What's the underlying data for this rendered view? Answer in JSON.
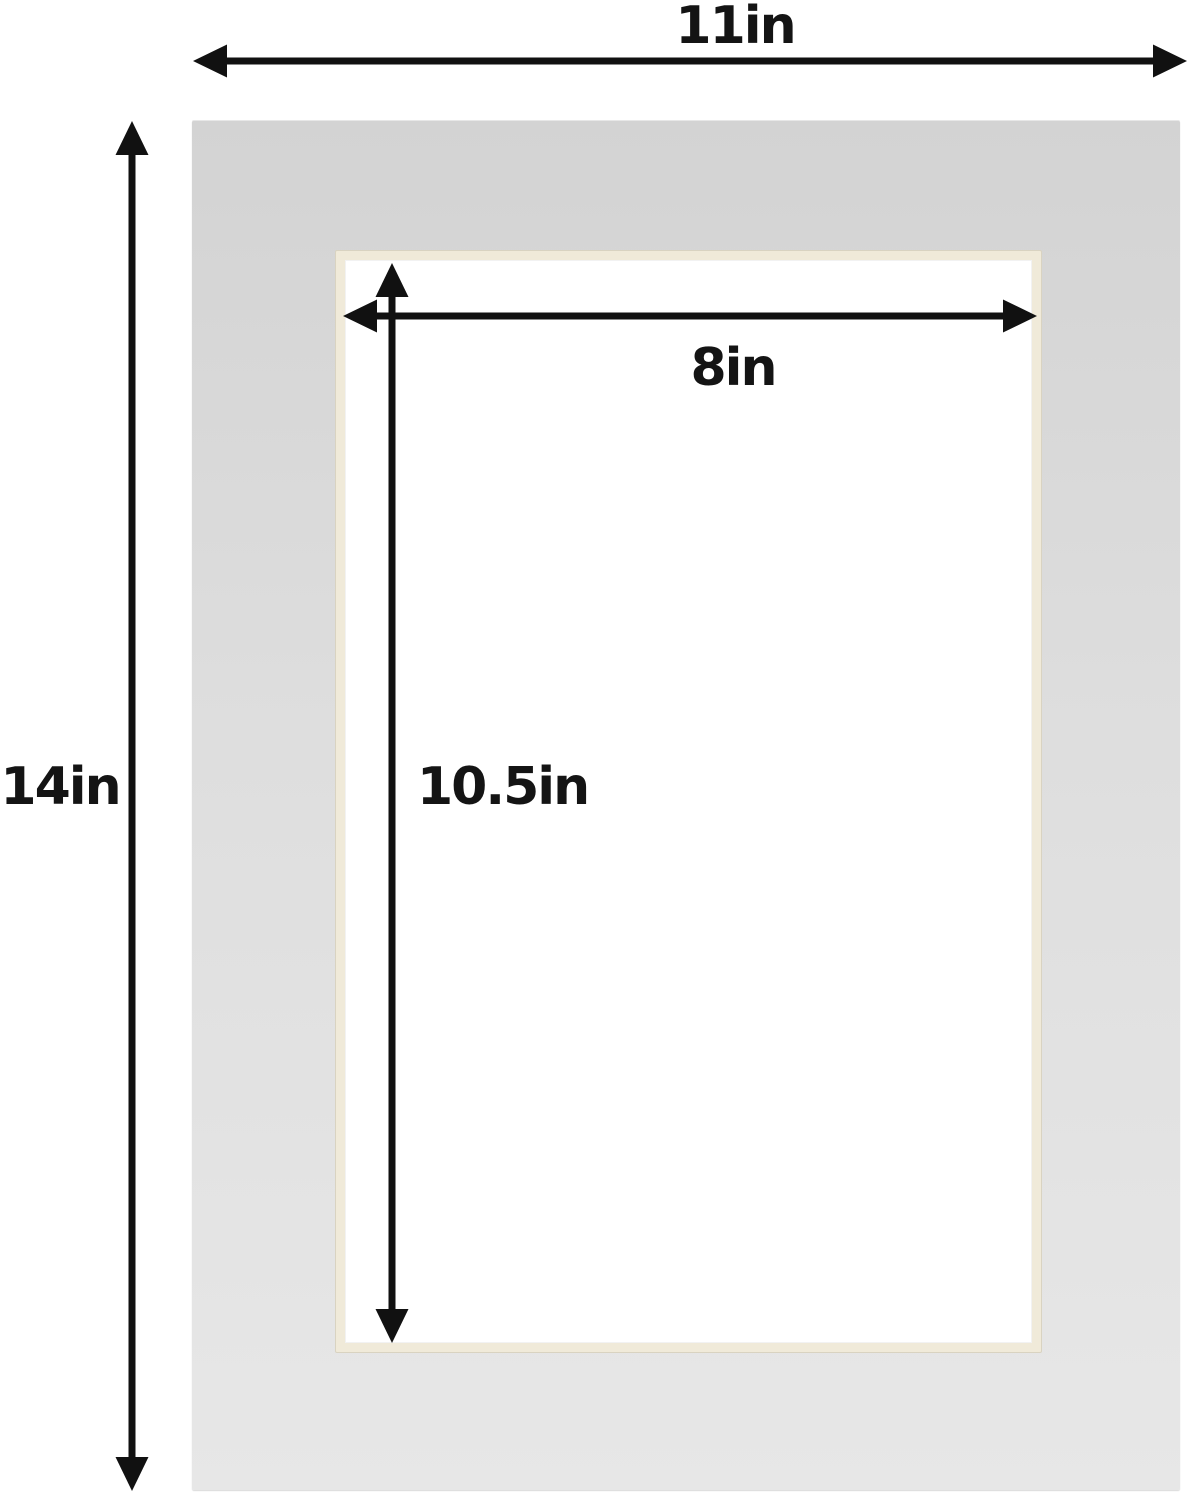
{
  "diagram": {
    "labels": {
      "outer_width": "11in",
      "outer_height": "14in",
      "opening_width": "8in",
      "opening_height": "10.5in"
    },
    "colors": {
      "background": "#ffffff",
      "mat_top": "#d3d3d3",
      "mat_bottom": "#e7e7e7",
      "bevel": "#f0ead9",
      "bevel_edge": "#d9d3c1",
      "opening": "#ffffff",
      "arrow": "#111111",
      "label_text": "#141414"
    }
  }
}
